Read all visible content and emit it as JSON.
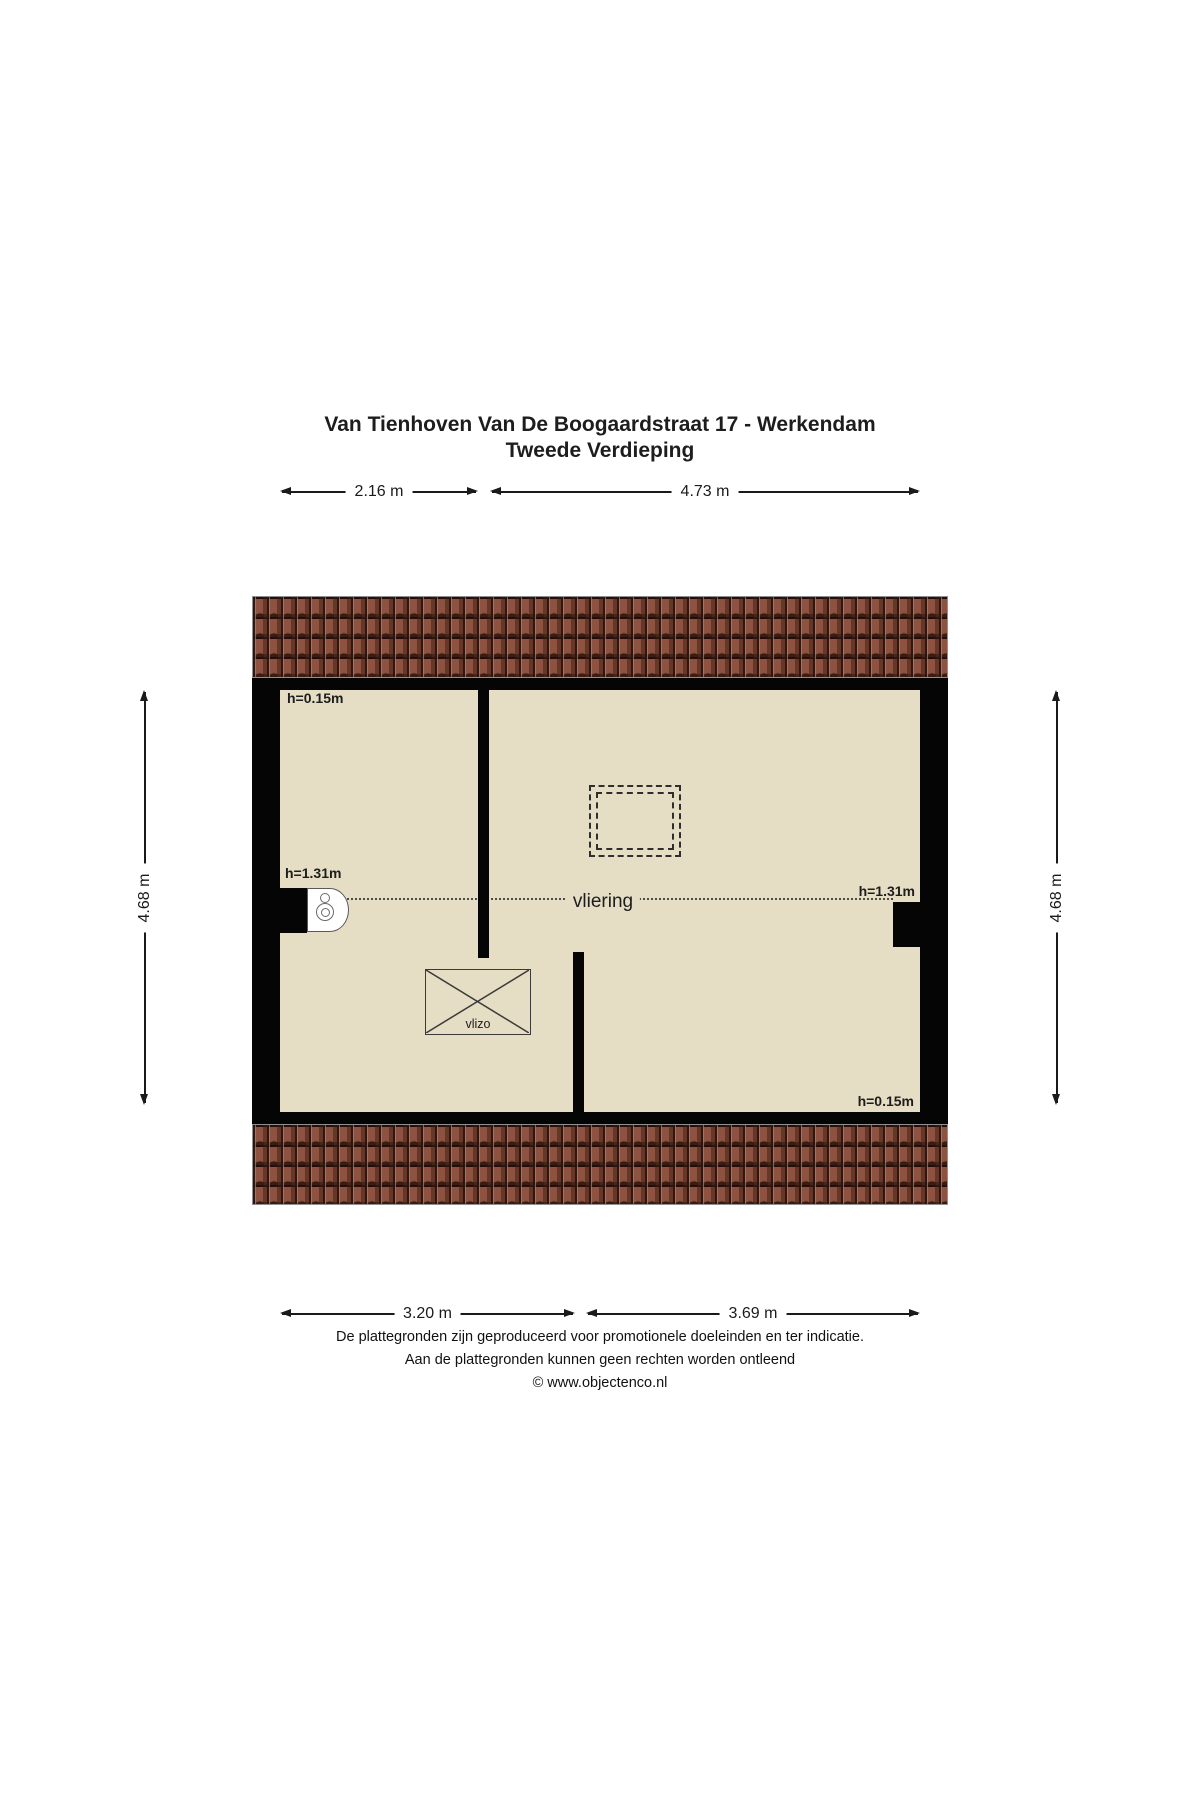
{
  "title": {
    "line1": "Van Tienhoven Van De Boogaardstraat 17 - Werkendam",
    "line2": "Tweede Verdieping"
  },
  "dimensions": {
    "top_left_width": "2.16 m",
    "top_right_width": "4.73 m",
    "bottom_left_width": "3.20 m",
    "bottom_right_width": "3.69 m",
    "left_height": "4.68 m",
    "right_height": "4.68 m"
  },
  "plan": {
    "room_label": "vliering",
    "hatch_label": "vlizo",
    "height_labels": {
      "top_left": "h=0.15m",
      "left": "h=1.31m",
      "right": "h=1.31m",
      "bottom_right": "h=0.15m"
    }
  },
  "icons": {
    "boiler": "boiler-icon",
    "skylight": "skylight-dashed-outline",
    "vlizo": "vlizotrap-hatch-icon",
    "roof": "roof-tiles"
  },
  "footer": {
    "line1": "De plattegronden zijn geproduceerd voor promotionele doeleinden en ter indicatie.",
    "line2": "Aan de plattegronden kunnen geen rechten worden ontleend",
    "line3": "© www.objectenco.nl"
  },
  "colors": {
    "floor": "#e5ddc4",
    "wall": "#050505",
    "roof_base": "#8e5340",
    "dimension": "#1a1a1a"
  }
}
